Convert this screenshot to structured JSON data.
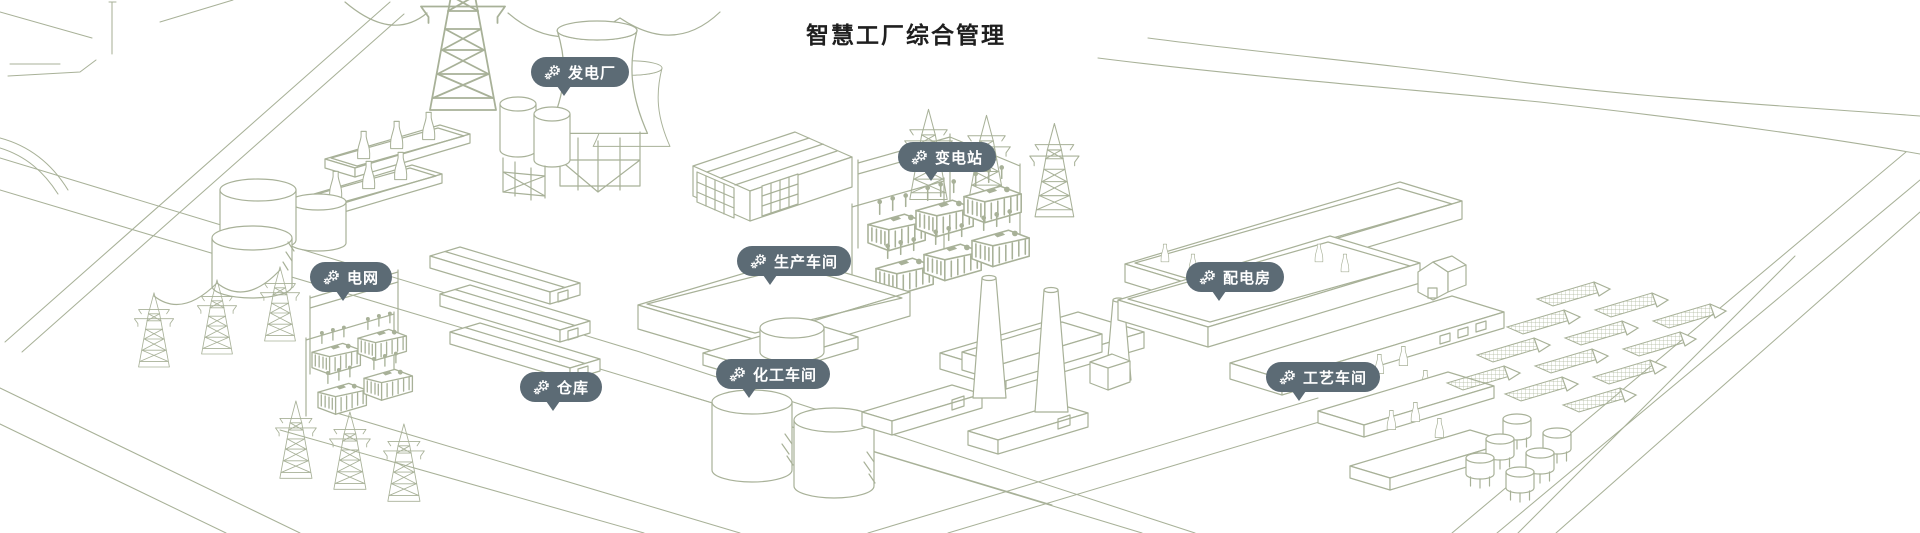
{
  "page": {
    "title": "智慧工厂综合管理"
  },
  "theme": {
    "background": "#ffffff",
    "title_color": "#1f1f1f",
    "pill_bg": "#5c6b75",
    "pill_text": "#ffffff",
    "line_color": "#a8b198"
  },
  "pins": [
    {
      "id": "power-plant",
      "label": "发电厂",
      "icon": "gear-icon"
    },
    {
      "id": "substation",
      "label": "变电站",
      "icon": "gear-icon"
    },
    {
      "id": "power-grid",
      "label": "电网",
      "icon": "gear-icon"
    },
    {
      "id": "production-workshop",
      "label": "生产车间",
      "icon": "gear-icon"
    },
    {
      "id": "distribution-room",
      "label": "配电房",
      "icon": "gear-icon"
    },
    {
      "id": "warehouse",
      "label": "仓库",
      "icon": "gear-icon"
    },
    {
      "id": "chemical-workshop",
      "label": "化工车间",
      "icon": "gear-icon"
    },
    {
      "id": "process-workshop",
      "label": "工艺车间",
      "icon": "gear-icon"
    }
  ]
}
